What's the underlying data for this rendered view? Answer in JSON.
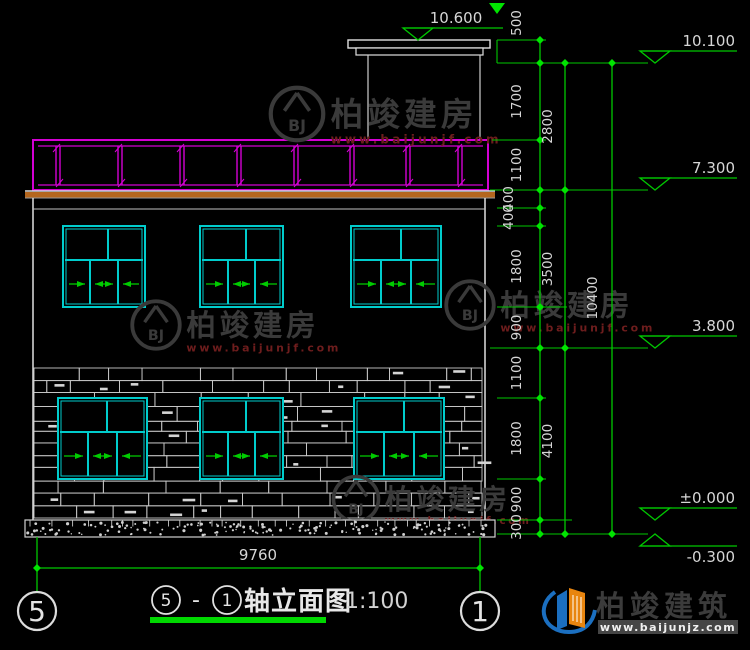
{
  "drawing": {
    "type": "axis-elevation",
    "scale_note": "1:100"
  },
  "title": {
    "axis_from": "5",
    "separator": "-",
    "axis_to": "1",
    "text": "轴立面图",
    "scale": "1:100"
  },
  "axes": {
    "left": "5",
    "right": "1"
  },
  "dimensions": {
    "top_elevation": "10.600",
    "top_small": "500",
    "right_tier1": [
      "500",
      "1700",
      "1100",
      "400",
      "400",
      "1800",
      "900",
      "1100",
      "1800",
      "900",
      "300"
    ],
    "right_tier2": [
      "2800",
      "3500",
      "4100"
    ],
    "right_tier3": [
      "10400"
    ],
    "bottom_width": "9760"
  },
  "elevation_markers": [
    {
      "label": "10.100"
    },
    {
      "label": "7.300"
    },
    {
      "label": "3.800"
    },
    {
      "label": "±0.000"
    },
    {
      "label": "-0.300"
    }
  ],
  "watermark": {
    "name": "柏竣建房",
    "url": "www.baijunjf.com",
    "monogram": "BJ"
  },
  "brand": {
    "name": "柏竣建筑",
    "url": "www.baijunjz.com"
  },
  "colors": {
    "dim_line_green": "#00c800",
    "dim_tick_green": "#00e400",
    "underline_green": "#00d800",
    "arrow_green": "#00cc00",
    "window_cyan": "#00cccc",
    "railing_magenta": "#d400d4",
    "band_orange": "#b4661e",
    "line_white": "#e0e0e0",
    "stone_gray": "#c8c8c8",
    "dim_text": "#d6d6d6",
    "watermark_gray": "#3a3a3a",
    "watermark_red": "#6e1d1d",
    "brand_text": "#3b3b3b",
    "brand_blue": "#1b6fc0",
    "brand_orange": "#e8850f"
  }
}
